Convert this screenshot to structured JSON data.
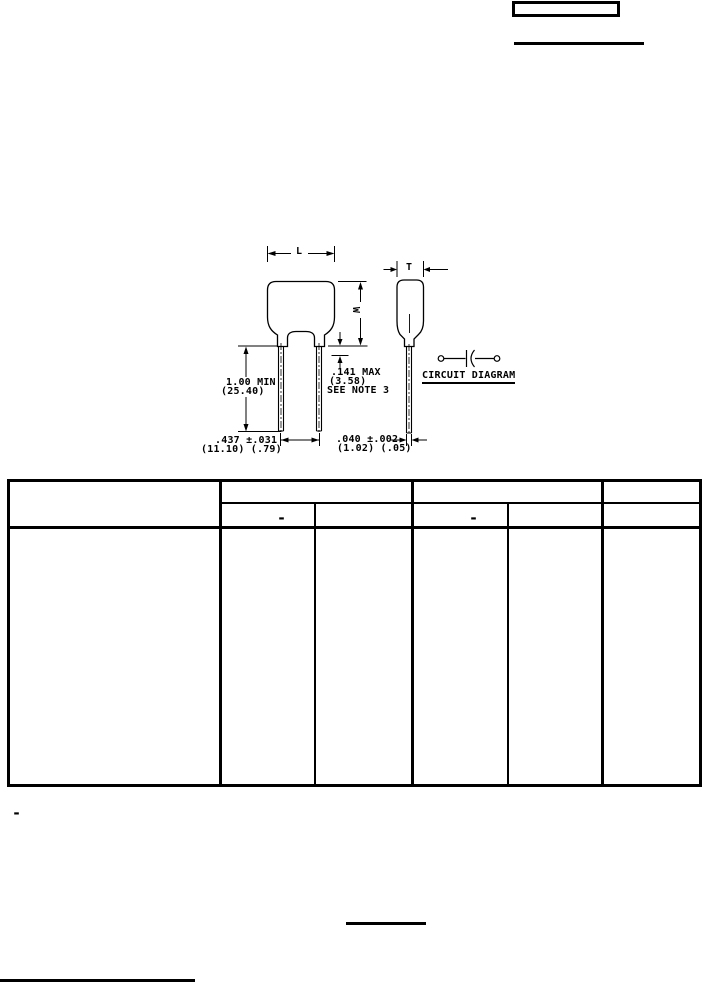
{
  "page": {
    "background": "#ffffff",
    "ink": "#000000"
  },
  "figure": {
    "dimension_labels": {
      "length": "L",
      "width": "W",
      "thickness": "T"
    },
    "annotations": {
      "lead_length": [
        "1.00 MIN",
        "(25.40)"
      ],
      "standoff_height": [
        ".141 MAX",
        "(3.58)",
        "SEE NOTE 3"
      ],
      "lead_spacing": [
        ".437 ±.031",
        "(11.10) (.79)"
      ],
      "lead_diameter": [
        ".040 ±.002",
        "(1.02) (.05)"
      ],
      "circuit_diagram_label": "CIRCUIT DIAGRAM"
    }
  },
  "table": {
    "columns": 6,
    "subheader": {
      "col2_dash": "-",
      "col4_dash": "-"
    }
  },
  "footnotes": {
    "marker_dash": "-"
  }
}
